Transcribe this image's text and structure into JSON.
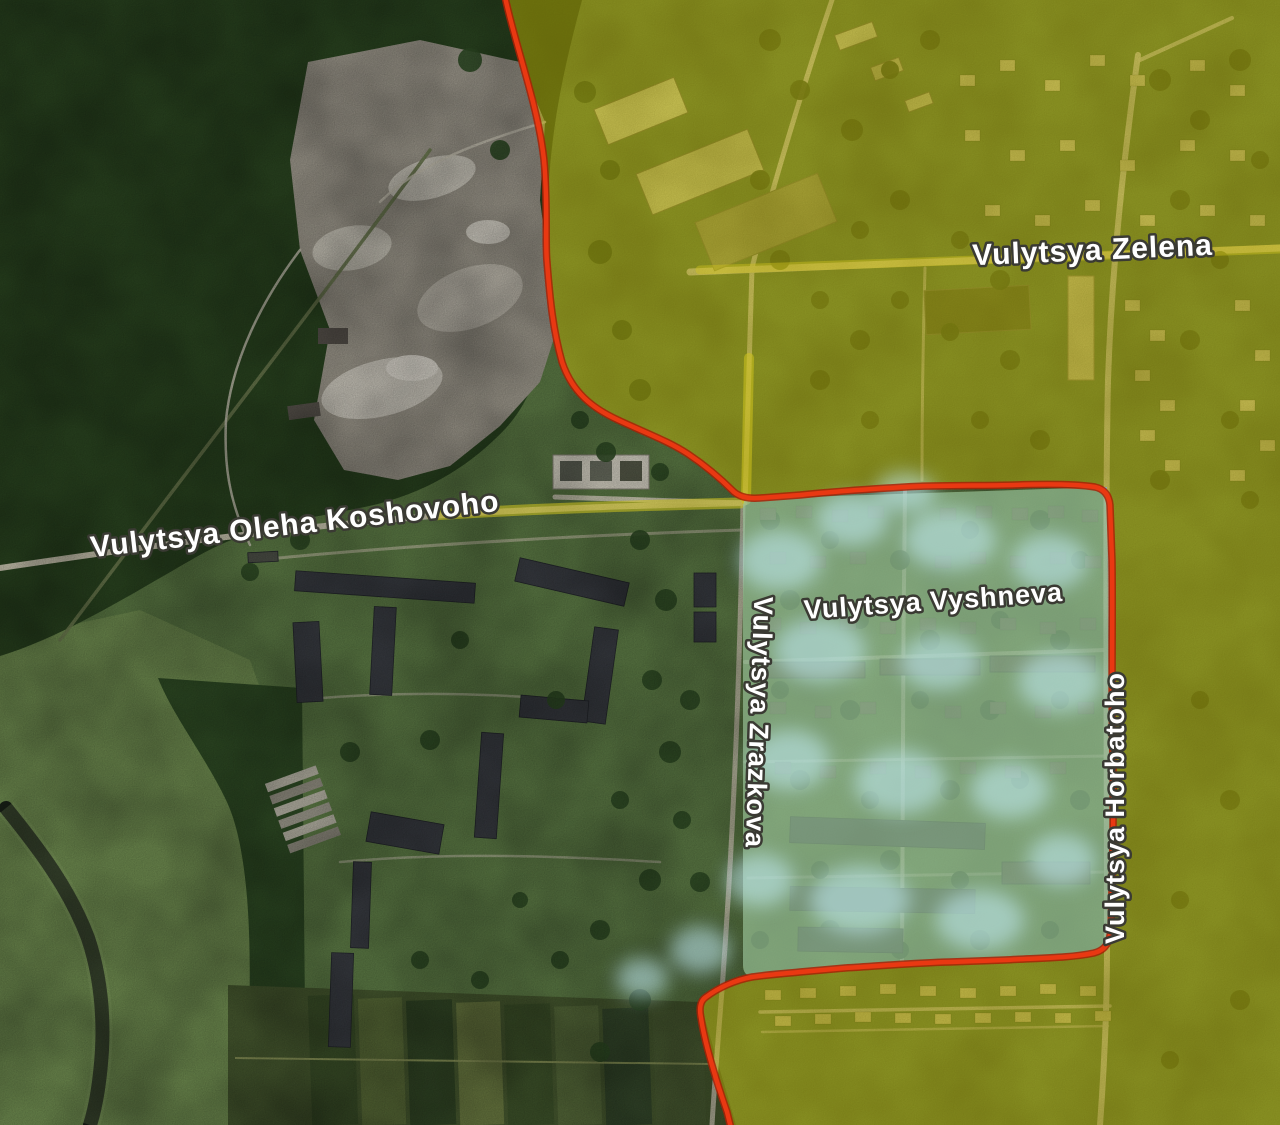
{
  "map": {
    "type": "annotated-satellite-map",
    "labels": {
      "street_zelena": "Vulytsya Zelena",
      "street_koshovoho": "Vulytsya Oleha Koshovoho",
      "street_vyshneva": "Vulytsya Vyshneva",
      "street_zrazkova": "Vulytsya Zrazkova",
      "street_horbatoho": "Vulytsya Horbatoho"
    },
    "zones": {
      "frontline_color": "#e93812",
      "frontline_edge_color": "#a82106",
      "yellow_zone_color": "#d4c400",
      "blue_zone_color": "#7cc3e6",
      "blue_cloud_color": "#c2ecf5"
    },
    "label_style": {
      "text_color": "#ffffff",
      "outline_color": "#3a3a33"
    }
  }
}
